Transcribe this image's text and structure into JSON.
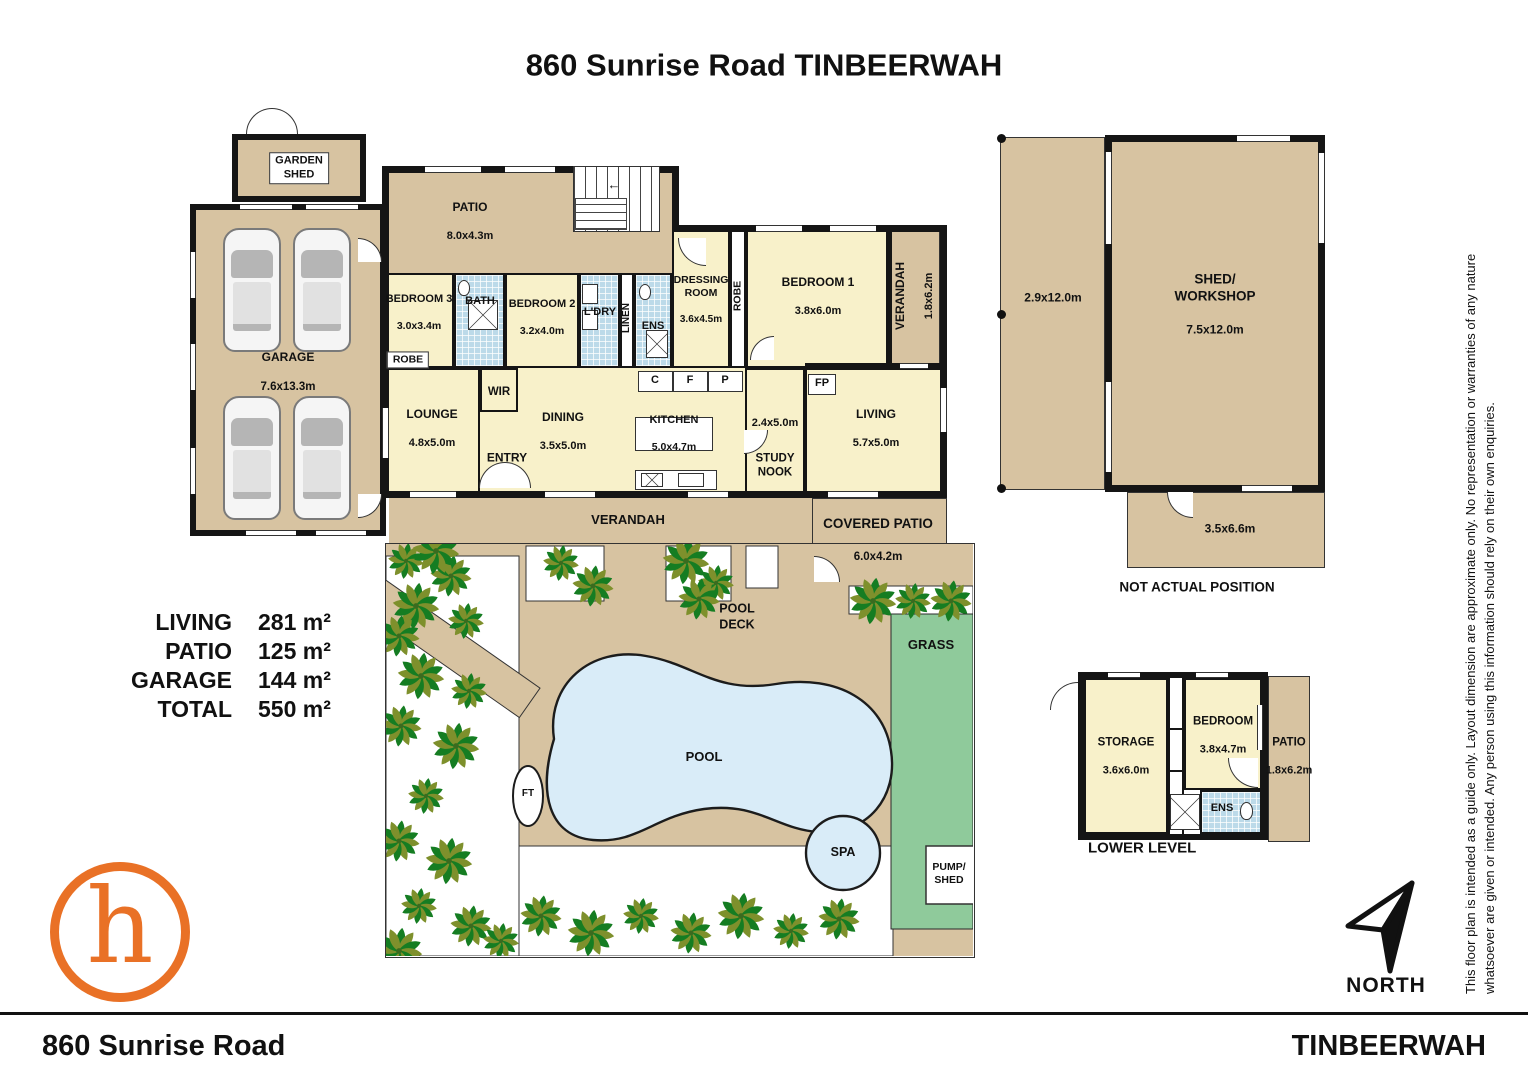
{
  "palette": {
    "tan": "#D7C3A1",
    "cream": "#F8F1CA",
    "tile_blue": "#BCDAE9",
    "pool_blue": "#D9ECF8",
    "grass_green": "#8FCA9B",
    "wall_black": "#151515",
    "logo_orange": "#E97126"
  },
  "title": "860 Sunrise Road TINBEERWAH",
  "house": {
    "patio": {
      "name": "PATIO",
      "dims": "8.0x4.3m"
    },
    "bedroom3": {
      "name": "BEDROOM 3",
      "dims": "3.0x3.4m"
    },
    "bath": {
      "name": "BATH"
    },
    "bedroom2": {
      "name": "BEDROOM 2",
      "dims": "3.2x4.0m"
    },
    "laundry": {
      "name": "L'DRY"
    },
    "linen": {
      "name": "LINEN"
    },
    "ensuite": {
      "name": "ENS"
    },
    "dressing": {
      "name": "DRESSING\nROOM",
      "dims": "3.6x4.5m"
    },
    "robe_strip": {
      "name": "ROBE"
    },
    "bedroom1": {
      "name": "BEDROOM 1",
      "dims": "3.8x6.0m"
    },
    "verandah_side": {
      "name": "VERANDAH",
      "dims": "1.8x6.2m"
    },
    "robe_box": {
      "name": "ROBE"
    },
    "wir": {
      "name": "WIR"
    },
    "lounge": {
      "name": "LOUNGE",
      "dims": "4.8x5.0m"
    },
    "entry": {
      "name": "ENTRY"
    },
    "dining": {
      "name": "DINING",
      "dims": "3.5x5.0m"
    },
    "kitchen": {
      "name": "KITCHEN",
      "dims": "5.0x4.7m"
    },
    "cabinet_c": "C",
    "cabinet_f": "F",
    "cabinet_p": "P",
    "study_nook": {
      "name": "STUDY\nNOOK",
      "dims": "2.4x5.0m"
    },
    "fireplace": "FP",
    "living": {
      "name": "LIVING",
      "dims": "5.7x5.0m"
    },
    "verandah_bottom": {
      "name": "VERANDAH"
    },
    "covered_patio": {
      "name": "COVERED PATIO",
      "dims": "6.0x4.2m"
    }
  },
  "outbuildings": {
    "garden_shed": {
      "name": "GARDEN\nSHED"
    },
    "garage": {
      "name": "GARAGE",
      "dims": "7.6x13.3m"
    },
    "carport": {
      "dims": "2.9x12.0m"
    },
    "shed_workshop": {
      "name": "SHED/\nWORKSHOP",
      "dims": "7.5x12.0m"
    },
    "shed_annex": {
      "dims": "3.5x6.6m"
    },
    "note": "NOT ACTUAL POSITION"
  },
  "yard": {
    "pool_deck": "POOL\nDECK",
    "pool": "POOL",
    "ft": "FT",
    "spa": "SPA",
    "grass": "GRASS",
    "pump_shed": "PUMP/\nSHED"
  },
  "lower_level": {
    "heading": "LOWER LEVEL",
    "storage": {
      "name": "STORAGE",
      "dims": "3.6x6.0m"
    },
    "bedroom": {
      "name": "BEDROOM",
      "dims": "3.8x4.7m"
    },
    "ensuite": {
      "name": "ENS"
    },
    "patio": {
      "name": "PATIO",
      "dims": "1.8x6.2m"
    }
  },
  "area_summary": {
    "rows": [
      {
        "label": "LIVING",
        "value": "281 m²"
      },
      {
        "label": "PATIO",
        "value": "125 m²"
      },
      {
        "label": "GARAGE",
        "value": "144 m²"
      },
      {
        "label": "TOTAL",
        "value": "550 m²"
      }
    ]
  },
  "compass": {
    "label": "NORTH"
  },
  "logo": {
    "letter": "h"
  },
  "disclaimer": {
    "line1": "This floor plan is intended as a guide only. Layout dimension are approximate only. No representation or warranties of any nature",
    "line2": "whatsoever are given or intended. Any person using this information should rely on their own enquiries."
  },
  "footer": {
    "left": "860 Sunrise Road",
    "right": "TINBEERWAH"
  }
}
